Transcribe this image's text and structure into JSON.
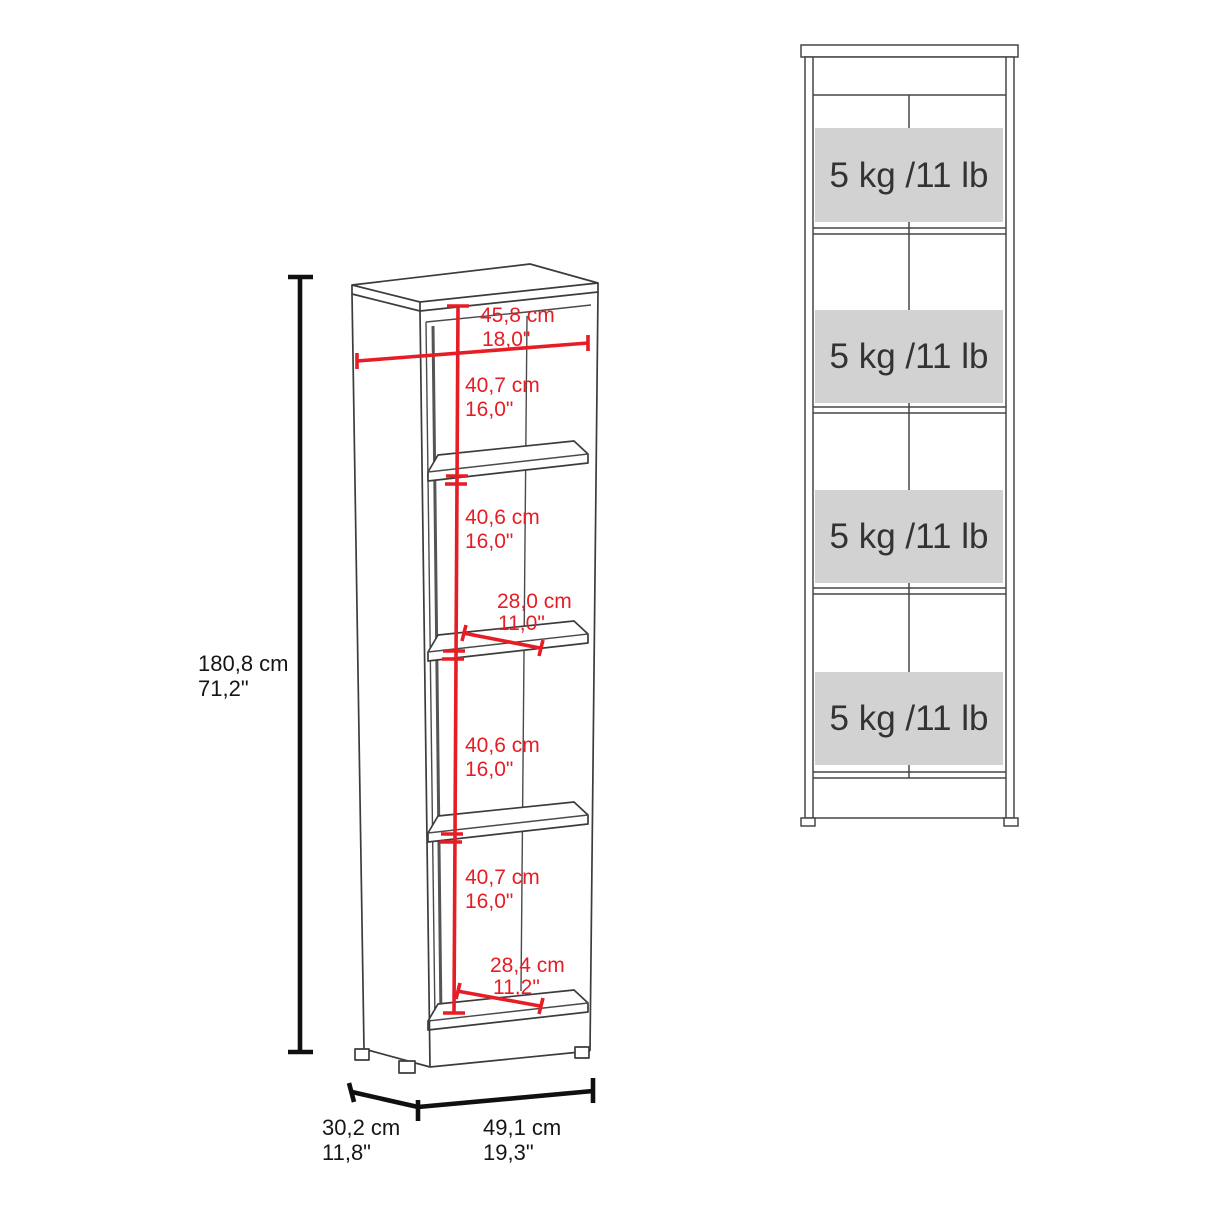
{
  "diagram_title": "bookcase-dimension-diagram",
  "colors": {
    "dimension_red": "#e71d25",
    "dimension_black": "#101010",
    "cabinet_line": "#3c3c3c",
    "load_label_background": "#d2d2d2",
    "load_label_text": "#333333",
    "background": "#ffffff"
  },
  "perspective_view": {
    "height_cm": "180,8 cm",
    "height_in": "71,2\"",
    "inner_width_cm": "45,8 cm",
    "inner_width_in": "18,0\"",
    "section1_cm": "40,7 cm",
    "section1_in": "16,0\"",
    "section2_cm": "40,6 cm",
    "section2_in": "16,0\"",
    "shelf_depth_cm": "28,0 cm",
    "shelf_depth_in": "11,0\"",
    "section3_cm": "40,6 cm",
    "section3_in": "16,0\"",
    "section4_cm": "40,7 cm",
    "section4_in": "16,0\"",
    "base_depth_cm": "28,4 cm",
    "base_depth_in": "11,2\"",
    "depth_cm": "30,2 cm",
    "depth_in": "11,8\"",
    "width_cm": "49,1 cm",
    "width_in": "19,3\""
  },
  "front_view": {
    "load_labels": [
      "5 kg /11 lb",
      "5 kg /11 lb",
      "5 kg /11 lb",
      "5 kg /11 lb"
    ]
  }
}
